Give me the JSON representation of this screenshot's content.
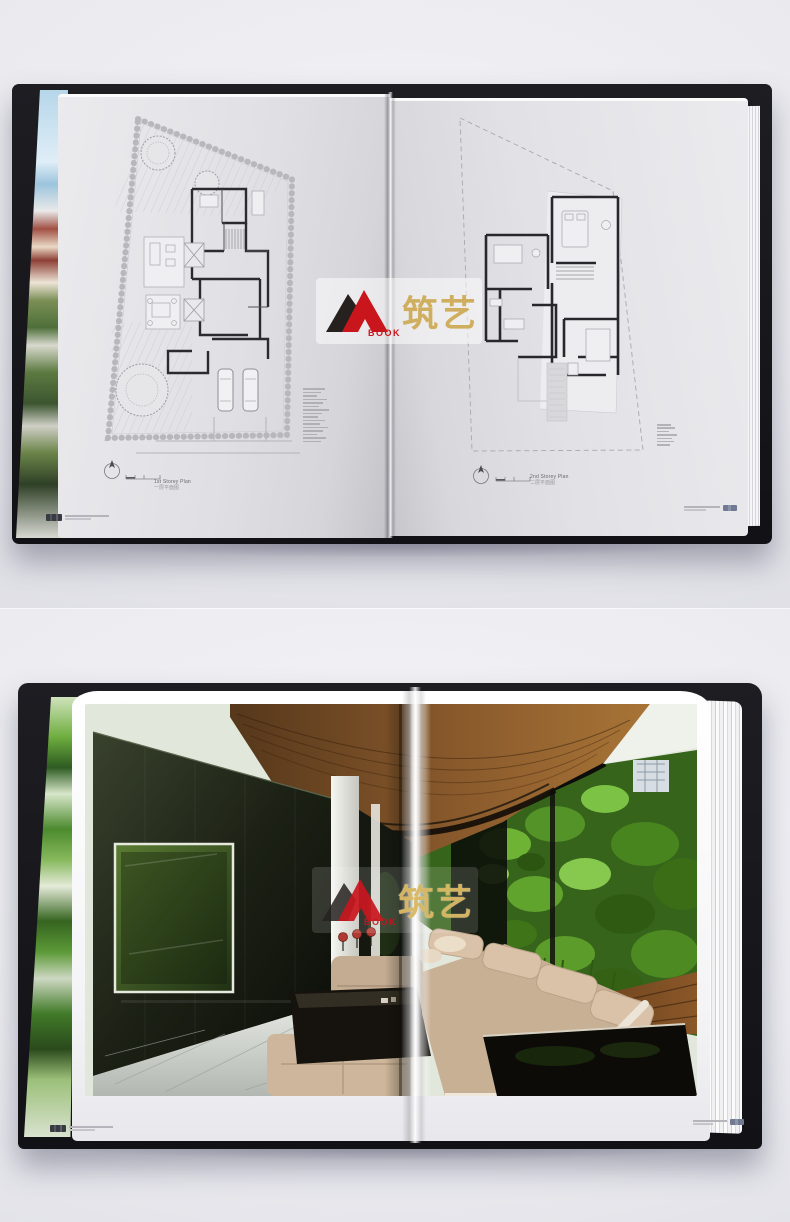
{
  "watermark": {
    "logo_icon": "mountain-logo-icon",
    "book_label": "BOOK",
    "brand_cn": "筑艺",
    "colors": {
      "logo_black": "#26211f",
      "logo_red": "#c9161d",
      "brand_gold": "#c7a144"
    }
  },
  "top_photo": {
    "left_page": {
      "plan_title": "1st Storey Plan",
      "plan_title_cn": "一层平面图",
      "legend_line_count": 16
    },
    "right_page": {
      "plan_title": "2nd Storey Plan",
      "plan_title_cn": "二层平面图",
      "legend_line_count": 7
    }
  },
  "colors": {
    "backdrop": "#eaeaef",
    "book_cover": "#16161a",
    "page_gray": "#dcdce0",
    "plan_ink": "#2b2b2e",
    "interior_wood": "#7a4c22",
    "interior_plant_green": "#4f8f22",
    "interior_sofa_beige": "#c9b096",
    "interior_marble": "#ccd1cb"
  }
}
